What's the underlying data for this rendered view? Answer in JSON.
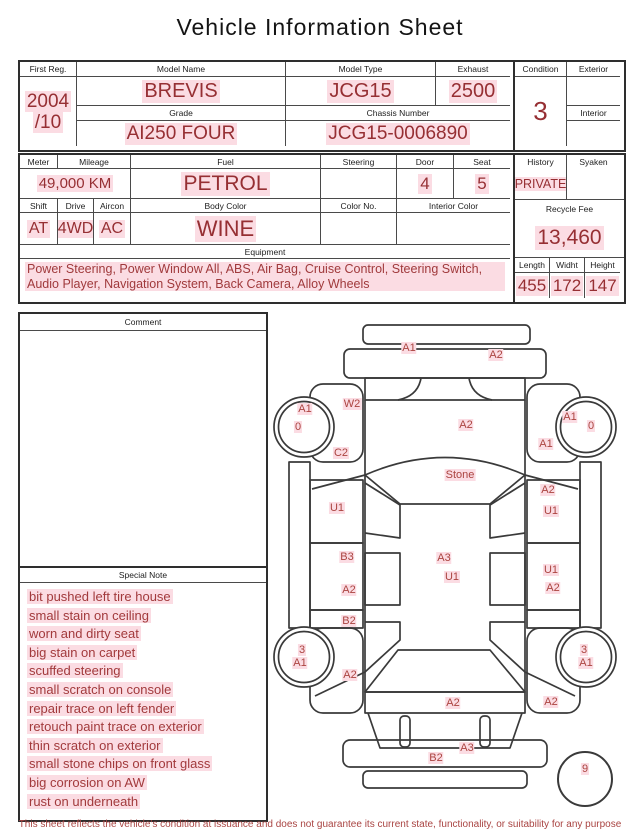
{
  "title": "Vehicle Information Sheet",
  "top_table": {
    "first_reg": {
      "label": "First Reg.",
      "line1": "2004",
      "line2": "/10"
    },
    "model_name": {
      "label": "Model Name",
      "value": "BREVIS"
    },
    "model_type": {
      "label": "Model Type",
      "value": "JCG15"
    },
    "exhaust": {
      "label": "Exhaust",
      "value": "2500"
    },
    "grade": {
      "label": "Grade",
      "value": "AI250 FOUR"
    },
    "chassis_number": {
      "label": "Chassis Number",
      "value": "JCG15-0006890"
    },
    "condition": {
      "label": "Condition",
      "value": "3"
    },
    "exterior": {
      "label": "Exterior",
      "value": ""
    },
    "interior": {
      "label": "Interior",
      "value": ""
    }
  },
  "spec_table": {
    "meter": {
      "label": "Meter"
    },
    "mileage": {
      "label": "Mileage",
      "value": "49,000 KM"
    },
    "fuel": {
      "label": "Fuel",
      "value": "PETROL"
    },
    "steering": {
      "label": "Steering",
      "value": ""
    },
    "door": {
      "label": "Door",
      "value": "4"
    },
    "seat": {
      "label": "Seat",
      "value": "5"
    },
    "shift": {
      "label": "Shift",
      "value": "AT"
    },
    "drive": {
      "label": "Drive",
      "value": "4WD"
    },
    "aircon": {
      "label": "Aircon",
      "value": "AC"
    },
    "body_color": {
      "label": "Body Color",
      "value": "WINE"
    },
    "color_no": {
      "label": "Color No.",
      "value": ""
    },
    "interior_color": {
      "label": "Interior Color",
      "value": ""
    },
    "equipment": {
      "label": "Equipment",
      "value": "Power Steering, Power Window  All, ABS, Air Bag, Cruise Control, Steering Switch, Audio Player, Navigation System, Back Camera, Alloy Wheels"
    },
    "history": {
      "label": "History",
      "value": "PRIVATE"
    },
    "syaken": {
      "label": "Syaken",
      "value": ""
    },
    "recycle_fee": {
      "label": "Recycle Fee",
      "value": "13,460"
    },
    "length": {
      "label": "Length",
      "value": "455"
    },
    "width": {
      "label": "Widht",
      "value": "172"
    },
    "height": {
      "label": "Height",
      "value": "147"
    }
  },
  "comment": {
    "label": "Comment",
    "value": ""
  },
  "special_note": {
    "label": "Special Note",
    "items": [
      "bit pushed left tire house",
      "small stain on ceiling",
      "worn and dirty seat",
      "big stain on carpet",
      "scuffed steering",
      "small scratch on console",
      "repair trace on left fender",
      "retouch paint trace on exterior",
      "thin scratch on exterior",
      "small stone chips on front glass",
      "big corrosion on AW",
      "rust on underneath"
    ]
  },
  "diagram": {
    "labels": [
      {
        "text": "A1",
        "x": 409,
        "y": 348
      },
      {
        "text": "A2",
        "x": 496,
        "y": 355
      },
      {
        "text": "W2",
        "x": 352,
        "y": 404
      },
      {
        "text": "A1",
        "x": 305,
        "y": 409
      },
      {
        "text": "0",
        "x": 298,
        "y": 427
      },
      {
        "text": "A1",
        "x": 570,
        "y": 417
      },
      {
        "text": "0",
        "x": 591,
        "y": 426
      },
      {
        "text": "A2",
        "x": 466,
        "y": 425
      },
      {
        "text": "A1",
        "x": 546,
        "y": 444
      },
      {
        "text": "C2",
        "x": 341,
        "y": 453
      },
      {
        "text": "Stone",
        "x": 460,
        "y": 475
      },
      {
        "text": "A2",
        "x": 548,
        "y": 490
      },
      {
        "text": "U1",
        "x": 337,
        "y": 508
      },
      {
        "text": "U1",
        "x": 551,
        "y": 511
      },
      {
        "text": "B3",
        "x": 347,
        "y": 557
      },
      {
        "text": "A3",
        "x": 444,
        "y": 558
      },
      {
        "text": "U1",
        "x": 452,
        "y": 577
      },
      {
        "text": "U1",
        "x": 551,
        "y": 570
      },
      {
        "text": "A2",
        "x": 349,
        "y": 590
      },
      {
        "text": "A2",
        "x": 553,
        "y": 588
      },
      {
        "text": "B2",
        "x": 349,
        "y": 621
      },
      {
        "text": "3",
        "x": 302,
        "y": 650
      },
      {
        "text": "A1",
        "x": 300,
        "y": 663
      },
      {
        "text": "3",
        "x": 584,
        "y": 650
      },
      {
        "text": "A1",
        "x": 586,
        "y": 663
      },
      {
        "text": "A2",
        "x": 350,
        "y": 675
      },
      {
        "text": "A2",
        "x": 453,
        "y": 703
      },
      {
        "text": "A2",
        "x": 551,
        "y": 702
      },
      {
        "text": "A3",
        "x": 467,
        "y": 748
      },
      {
        "text": "B2",
        "x": 436,
        "y": 758
      },
      {
        "text": "9",
        "x": 585,
        "y": 769
      }
    ]
  },
  "footer": {
    "disclaimer": "This sheet reflects the vehicle's condition at issuance and does not guarantee its current state, functionality, or suitability for any purpose"
  },
  "colors": {
    "accent_red": "#962f33",
    "highlight_pink": "#fbdce3"
  }
}
